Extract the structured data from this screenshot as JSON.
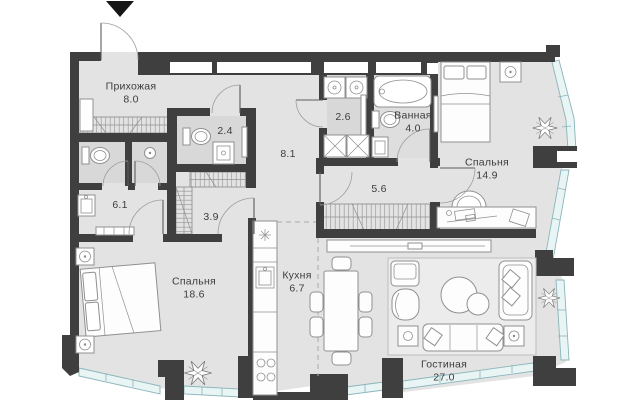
{
  "plan": {
    "type": "apartment-floor-plan",
    "entrance_marker": "down-arrow",
    "rooms": [
      {
        "id": "hallway",
        "name": "Прихожая",
        "area": "8.0",
        "cx": 131,
        "cy": 93
      },
      {
        "id": "wc-2-4",
        "name": "",
        "area": "2.4",
        "cx": 225,
        "cy": 131
      },
      {
        "id": "laundry",
        "name": "",
        "area": "2.6",
        "cx": 343,
        "cy": 117
      },
      {
        "id": "bathroom",
        "name": "Ванная",
        "area": "4.0",
        "cx": 413,
        "cy": 122
      },
      {
        "id": "bedroom-2",
        "name": "Спальня",
        "area": "14.9",
        "cx": 487,
        "cy": 169
      },
      {
        "id": "hall-8-1",
        "name": "",
        "area": "8.1",
        "cx": 288,
        "cy": 154
      },
      {
        "id": "corridor",
        "name": "",
        "area": "5.6",
        "cx": 379,
        "cy": 189
      },
      {
        "id": "wc-6-1",
        "name": "",
        "area": "6.1",
        "cx": 120,
        "cy": 205
      },
      {
        "id": "wardrobe",
        "name": "",
        "area": "3.9",
        "cx": 211,
        "cy": 217
      },
      {
        "id": "bedroom-1",
        "name": "Спальня",
        "area": "18.6",
        "cx": 194,
        "cy": 288
      },
      {
        "id": "kitchen",
        "name": "Кухня",
        "area": "6.7",
        "cx": 297,
        "cy": 282
      },
      {
        "id": "living",
        "name": "Гостиная",
        "area": "27.0",
        "cx": 444,
        "cy": 371
      }
    ],
    "colors": {
      "wall": "#3f3f3f",
      "floor": "#e3e3e3",
      "wet": "#d8d8d8",
      "wet2": "#dedede",
      "glass": "#e9f4f4",
      "glass_stroke": "#8ab5bb",
      "line": "#909090",
      "label": "#3d3d3d"
    }
  }
}
